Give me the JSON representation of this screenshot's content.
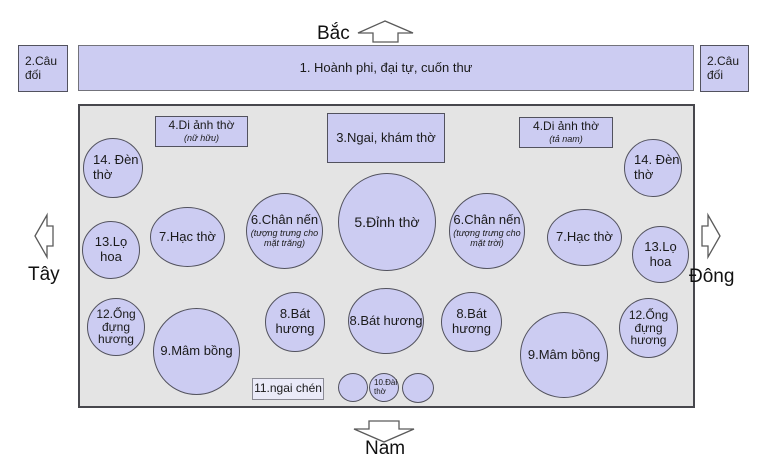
{
  "compass": {
    "north": "Bắc",
    "south": "Nam",
    "west": "Tây",
    "east": "Đông"
  },
  "top": {
    "banner": "1. Hoành phi, đại tự, cuốn thư",
    "couplet_left": [
      "2.Câu",
      "đối"
    ],
    "couplet_right": [
      "2.Câu",
      "đối"
    ]
  },
  "altar": {
    "photo_left": {
      "label": "4.Di ảnh thờ",
      "sub": "(nữ hữu)"
    },
    "shrine": "3.Ngai, khám thờ",
    "photo_right": {
      "label": "4.Di ảnh thờ",
      "sub": "(tả nam)"
    },
    "lamp_left": [
      "14. Đèn",
      "thờ"
    ],
    "lamp_right": [
      "14. Đèn",
      "thờ"
    ],
    "vase_left": "13.Lọ hoa",
    "vase_right": "13.Lọ hoa",
    "crane_left": "7.Hạc thờ",
    "crane_right": "7.Hạc thờ",
    "candle_left": {
      "label": "6.Chân nến",
      "sub": [
        "(tượng trưng cho",
        "mặt trăng)"
      ]
    },
    "candle_right": {
      "label": "6.Chân nến",
      "sub": [
        "(tượng trưng cho",
        "mặt trời)"
      ]
    },
    "censer": "5.Đỉnh thờ",
    "incense_tube_left": [
      "12.Ống",
      "đựng",
      "hương"
    ],
    "incense_tube_right": [
      "12.Ống",
      "đựng",
      "hương"
    ],
    "fruit_tray_left": "9.Mâm bồng",
    "fruit_tray_right": "9.Mâm bồng",
    "incense_bowl_left": [
      "8.Bát",
      "hương"
    ],
    "incense_bowl_center": "8.Bát hương",
    "incense_bowl_right": [
      "8.Bát",
      "hương"
    ],
    "cup_tray": "11.ngai chén",
    "water_stand": [
      "10.Đài",
      "thờ"
    ]
  },
  "colors": {
    "item_fill": "#ccccf2",
    "panel_fill": "#e4e4e4",
    "outline": "#52525e",
    "background": "#ffffff"
  }
}
